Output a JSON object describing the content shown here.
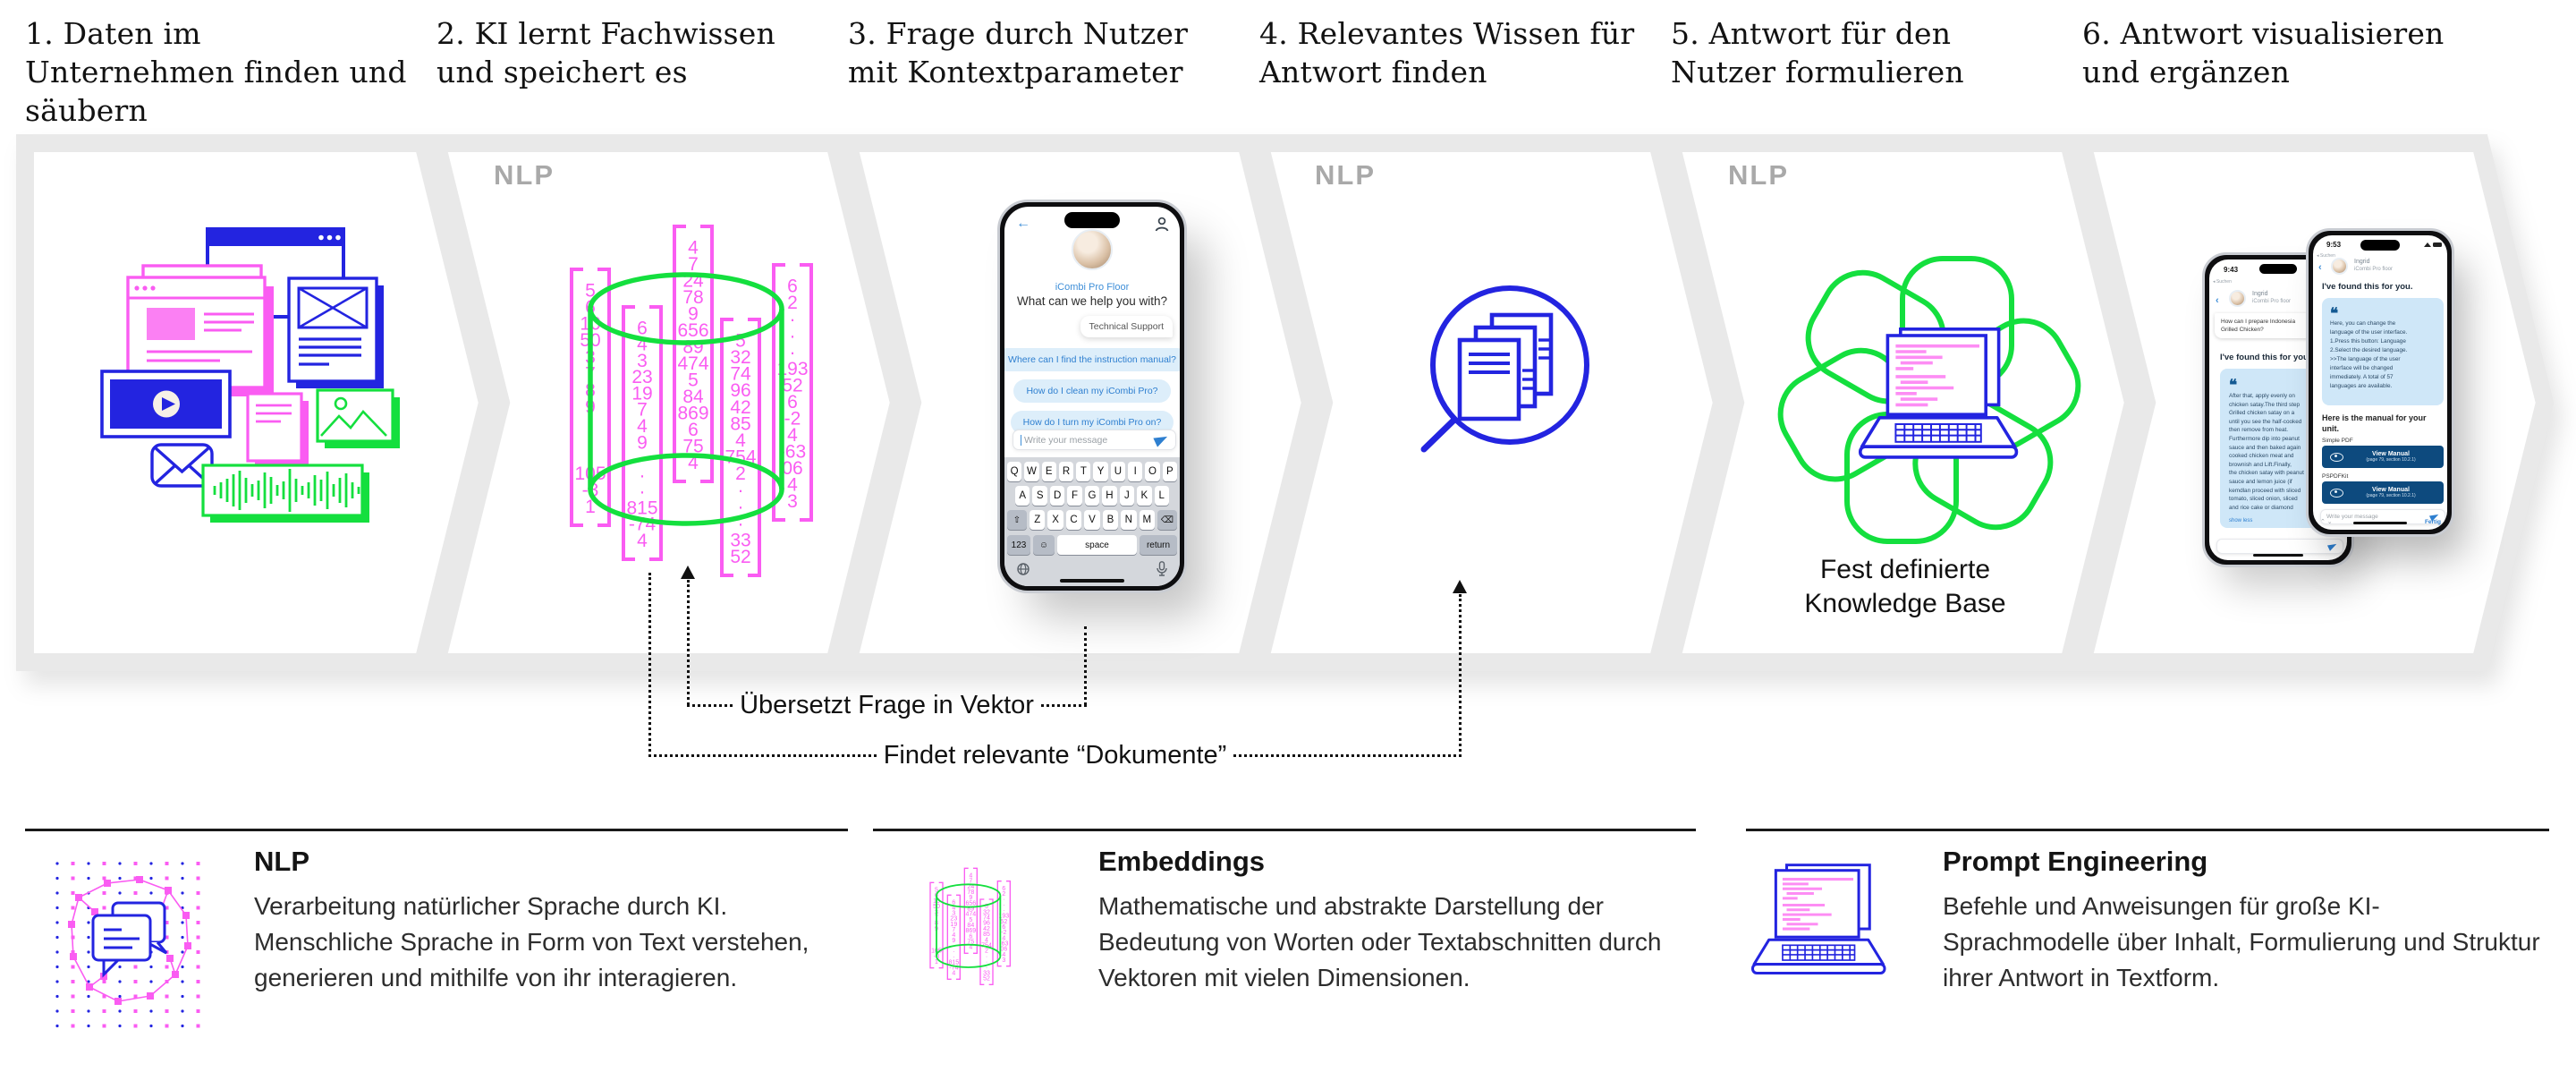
{
  "steps": [
    {
      "title": "1. Daten im Unternehmen finden und säubern",
      "badge": ""
    },
    {
      "title": "2. KI lernt Fachwissen und speichert es",
      "badge": "NLP"
    },
    {
      "title": "3. Frage durch Nutzer mit Kontextparameter",
      "badge": ""
    },
    {
      "title": "4. Relevantes Wissen für Antwort finden",
      "badge": "NLP"
    },
    {
      "title": "5. Antwort für den Nutzer formulieren",
      "badge": "NLP"
    },
    {
      "title": "6. Antwort visualisieren und ergänzen",
      "badge": ""
    }
  ],
  "step2_vectors": {
    "columns": [
      [
        "5",
        "6",
        "10",
        "50",
        "3",
        "7",
        "8",
        "9",
        "·",
        "·",
        "·",
        "105",
        "-3",
        "1"
      ],
      [
        "6",
        "4",
        "3",
        "23",
        "19",
        "7",
        "4",
        "9",
        "·",
        "·",
        "·",
        "815",
        "-74",
        "4"
      ],
      [
        "4",
        "7",
        "24",
        "78",
        "9",
        "656",
        "89",
        "474",
        "5",
        "84",
        "869",
        "6",
        "75",
        "4"
      ],
      [
        "5",
        "32",
        "74",
        "96",
        "42",
        "85",
        "4",
        "754",
        "2",
        "·",
        "·",
        "·",
        "33",
        "52"
      ],
      [
        "6",
        "2",
        "·",
        "·",
        "·",
        "193",
        "52",
        "6",
        "-2",
        "4",
        "-63",
        "06",
        "4",
        "3"
      ]
    ]
  },
  "step3_phone": {
    "contact": "iCombi Pro Floor",
    "greeting": "What can we help you with?",
    "user_message": "Technical Support",
    "suggestions": [
      "Where can I find the instruction manual?",
      "How do I clean my iCombi Pro?",
      "How do I turn my iCombi Pro on?"
    ],
    "input_placeholder": "Write your message",
    "keyboard": {
      "row1": [
        "Q",
        "W",
        "E",
        "R",
        "T",
        "Y",
        "U",
        "I",
        "O",
        "P"
      ],
      "row2": [
        "A",
        "S",
        "D",
        "F",
        "G",
        "H",
        "J",
        "K",
        "L"
      ],
      "row3": [
        "Z",
        "X",
        "C",
        "V",
        "B",
        "N",
        "M"
      ],
      "shift": "⇧",
      "backspace": "⌫",
      "mode": "123",
      "emoji": "☺",
      "space": "space",
      "return": "return"
    }
  },
  "step5": {
    "caption_line1": "Fest definierte",
    "caption_line2": "Knowledge Base"
  },
  "step6": {
    "back_phone": {
      "status_back": "◂ Suchen",
      "time": "9:43",
      "contact_name": "Ingrid",
      "contact_sub": "iCombi Pro floor",
      "user_message": "How can I prepare Indonesia\nGrilled Chicken?",
      "found": "I've found this for you",
      "quote_text": "After that, apply evenly on\nchicken satay.The third step\nGrilled chicken satay on a\nuntil you see the half-cooked\nthen remove from heat.\nFurthermore dip into peanut\nsauce and then baked again\ncooked chicken meat and\nbrownish and Lift.Finally,\nthe chicken satay with peanut\nsauce and lemon juice (if\nkemdlan proceed with sliced\ntomato, sliced onion, sliced\nand rice cake or diamond",
      "show_less": "show less"
    },
    "front_phone": {
      "status_back": "◂ Suchen",
      "time": "9:53",
      "contact_name": "Ingrid",
      "contact_sub": "iCombi Pro floor",
      "found": "I've found this for you.",
      "quote_text": "Here, you can change the\nlanguage of the user interface.\n1.Press this button: Language\n2.Select the desired language.\n>>The language of the user\ninterface will be changed\nimmediately. A total of 57\nlanguages are available.",
      "manual_heading": "Here is the manual for your unit.",
      "label1": "Simple PDF",
      "label2": "PSPDFKit",
      "button_label": "View Manual",
      "button_sub": "(page 79, section 10.2.1)",
      "input_placeholder": "Write your message",
      "done": "Fertig"
    }
  },
  "annotations": {
    "vector_label": "Übersetzt Frage in Vektor",
    "documents_label": "Findet relevante “Dokumente”"
  },
  "glossary": [
    {
      "term": "NLP",
      "definition": "Verarbeitung natürlicher Sprache durch KI. Menschliche Sprache in Form von Text verstehen, generieren und mithilfe von ihr interagieren."
    },
    {
      "term": "Embeddings",
      "definition": "Mathematische und abstrakte Darstellung der Bedeutung von Worten oder Textabschnitten durch Vektoren mit vielen Dimensionen."
    },
    {
      "term": "Prompt Engineering",
      "definition": "Befehle und Anweisungen für große KI-Sprachmodelle über Inhalt, Formulierung und Struktur ihrer Antwort in Textform."
    }
  ],
  "colors": {
    "pink": "#fa5cf2",
    "green": "#14df3e",
    "blue": "#2324e0",
    "chevron_gray": "#e9e9e9",
    "nlp_gray": "#a9a9a9",
    "chat_blue_text": "#2e7fd0",
    "chat_bubble": "#ddeefa",
    "quote_card": "#cfe7f8",
    "button_navy": "#0d4a7e"
  }
}
